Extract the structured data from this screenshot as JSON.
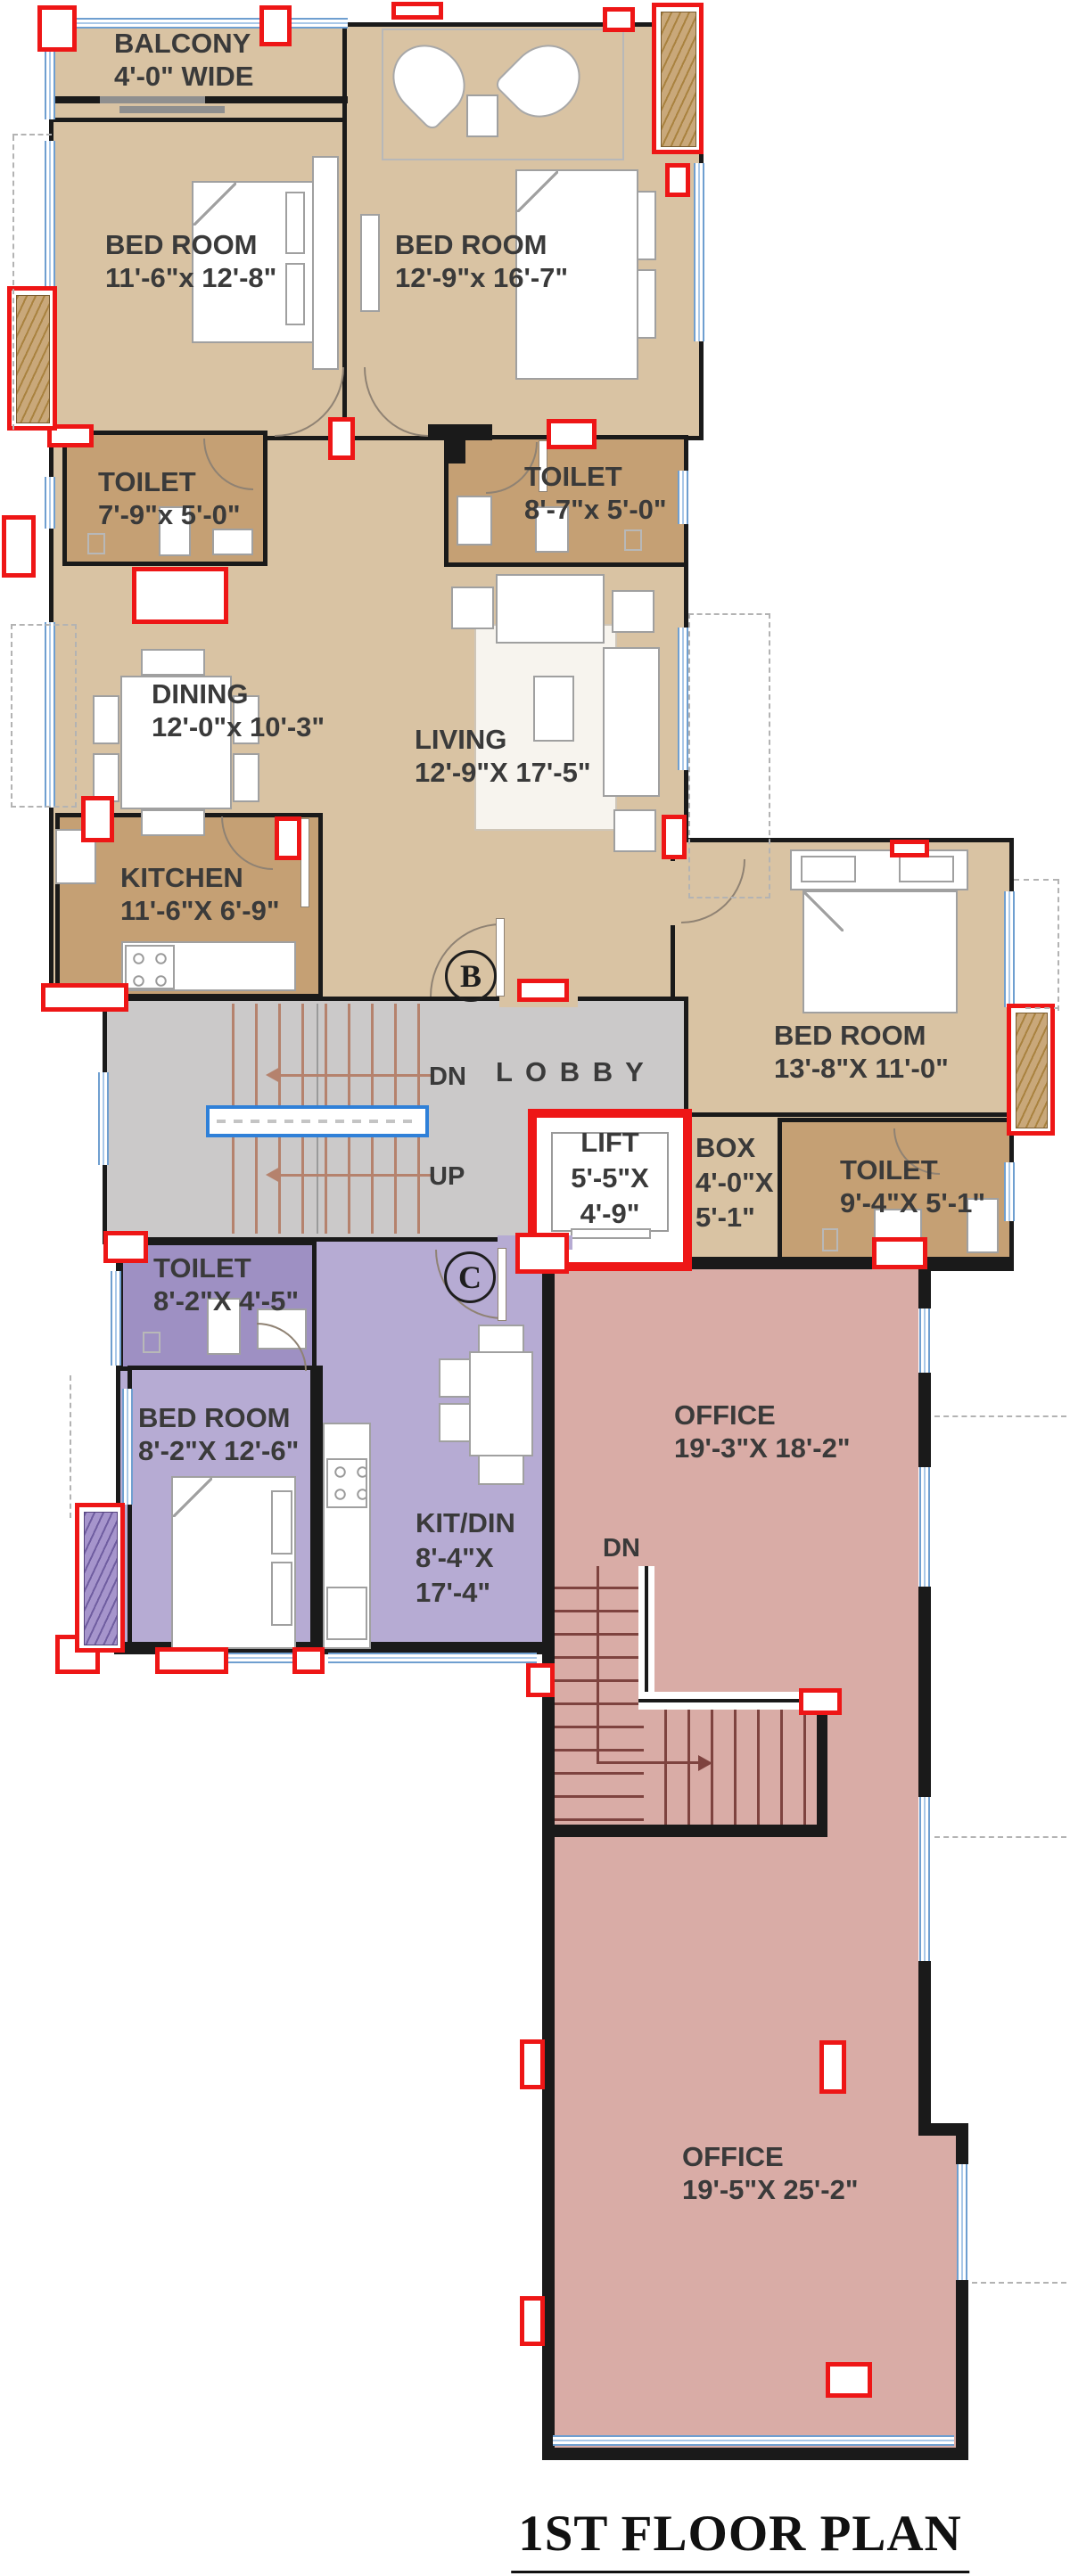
{
  "title": "1ST FLOOR PLAN",
  "markers": {
    "unit_b": "B",
    "unit_c": "C"
  },
  "stair_labels": {
    "lobby_down": "DN",
    "lobby_up": "UP",
    "office_down": "DN"
  },
  "rooms": {
    "balcony": {
      "lines": [
        "BALCONY",
        "4'-0\" WIDE"
      ]
    },
    "bedroom1": {
      "lines": [
        "BED ROOM",
        "11'-6\"x 12'-8\""
      ]
    },
    "bedroom2": {
      "lines": [
        "BED ROOM",
        "12'-9\"x 16'-7\""
      ]
    },
    "toilet1": {
      "lines": [
        "TOILET",
        "7'-9\"x 5'-0\""
      ]
    },
    "toilet2": {
      "lines": [
        "TOILET",
        "8'-7\"x 5'-0\""
      ]
    },
    "dining": {
      "lines": [
        "DINING",
        "12'-0\"x 10'-3\""
      ]
    },
    "living": {
      "lines": [
        "LIVING",
        "12'-9\"X 17'-5\""
      ]
    },
    "kitchen": {
      "lines": [
        "KITCHEN",
        "11'-6\"X 6'-9\""
      ]
    },
    "lobby": {
      "lines": [
        "L O B B Y"
      ]
    },
    "bedroom3": {
      "lines": [
        "BED ROOM",
        "13'-8\"X 11'-0\""
      ]
    },
    "lift": {
      "lines": [
        "LIFT",
        "5'-5\"X",
        "4'-9\""
      ]
    },
    "box": {
      "lines": [
        "BOX",
        "4'-0\"X",
        "5'-1\""
      ]
    },
    "toilet3": {
      "lines": [
        "TOILET",
        "9'-4\"X 5'-1\""
      ]
    },
    "toilet_c": {
      "lines": [
        "TOILET",
        "8'-2\"X 4'-5\""
      ]
    },
    "bedroom_c": {
      "lines": [
        "BED ROOM",
        "8'-2\"X 12'-6\""
      ]
    },
    "kitdin_c": {
      "lines": [
        "KIT/DIN",
        "8'-4\"X",
        "17'-4\""
      ]
    },
    "office_upper": {
      "lines": [
        "OFFICE",
        "19'-3\"X 18'-2\""
      ]
    },
    "office_lower": {
      "lines": [
        "OFFICE",
        "19'-5\"X 25'-2\""
      ]
    }
  },
  "colors": {
    "unit_b_floor": "#d9c3a3",
    "wet_room_floor": "#c5a074",
    "lobby_floor": "#cbc9c9",
    "unit_c_floor": "#b6abd3",
    "unit_c_wet": "#9e90c3",
    "office_floor": "#d9aca6",
    "office_stair": "#b4625c",
    "column_red": "#ee1616",
    "window_blue": "#6f9fd0",
    "wall_black": "#1a1a1a",
    "landing_blue": "#2f80d8"
  }
}
